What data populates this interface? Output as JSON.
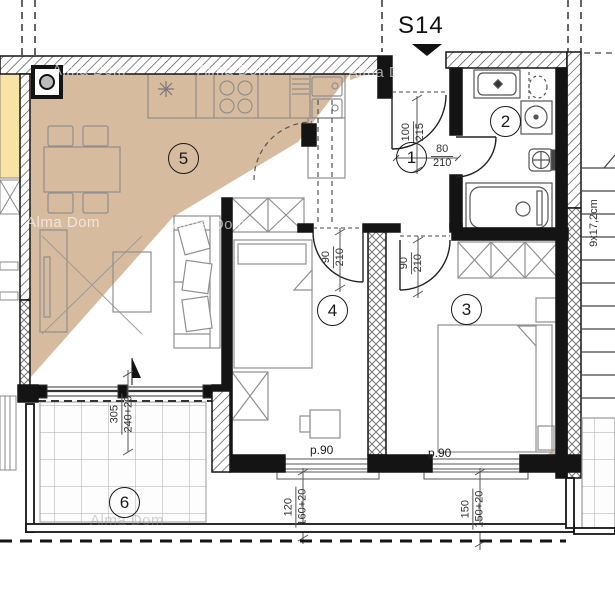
{
  "title": {
    "section_label": "S14"
  },
  "watermark": {
    "text": "Alma Dom"
  },
  "room_labels": {
    "hall": "1",
    "bathroom": "2",
    "bedroom_right": "3",
    "bedroom_mid": "4",
    "living_kitchen": "5",
    "terrace": "6"
  },
  "dimensions": {
    "entry_door_width": "100",
    "entry_door_height": "215",
    "bath_door_width": "80",
    "bath_door_height": "210",
    "bedroom_mid_door_width": "90",
    "bedroom_mid_door_height": "210",
    "bedroom_right_door_width": "90",
    "bedroom_right_door_height": "210",
    "terrace_opening_width": "305",
    "terrace_opening_height": "240+20",
    "bedroom_mid_window_width": "120",
    "bedroom_mid_window_height": "160+20",
    "bedroom_right_window_width": "150",
    "bedroom_right_window_height": "150+20",
    "parapet_mid": "p.90",
    "parapet_right": "p.90",
    "stair_step": "9x17,2cm"
  },
  "colors": {
    "unit_highlight": "#d7bb9e",
    "neighbor_unit": "#f8e3a5",
    "wall": "#141414"
  }
}
